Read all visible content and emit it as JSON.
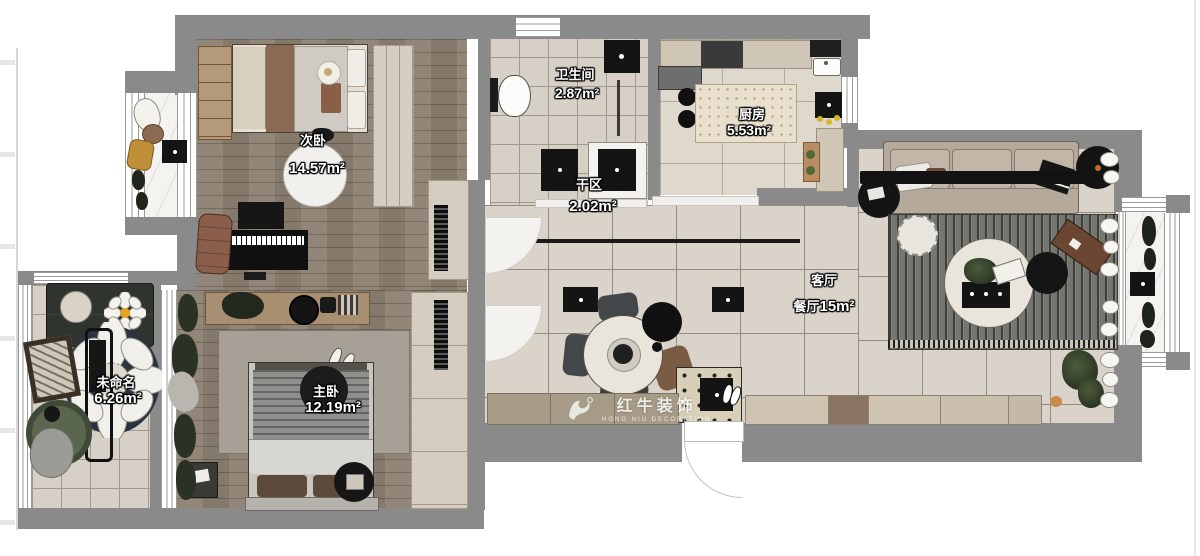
{
  "rooms": {
    "bedroom2": {
      "name": "次卧",
      "area": "14.57m²"
    },
    "bathroom": {
      "name": "卫生间",
      "area": "2.87m²"
    },
    "kitchen": {
      "name": "厨房",
      "area": "5.53m²"
    },
    "dry_area": {
      "name": "干区",
      "area": "2.02m²"
    },
    "living": {
      "name": "客厅",
      "name2": "餐厅",
      "area": "15m²"
    },
    "unnamed": {
      "name": "未命名",
      "area": "6.26m²"
    },
    "master": {
      "name": "主卧",
      "area": "12.19m²"
    }
  },
  "watermark": {
    "brand": "红牛装饰",
    "tagline": "HONG NIU DECORATION"
  },
  "colors": {
    "wall": "#8a8a8a",
    "wood_floor": "#8c7f72",
    "tile_floor": "#d9d3c9",
    "accent_sofa": "#b5a99b"
  }
}
